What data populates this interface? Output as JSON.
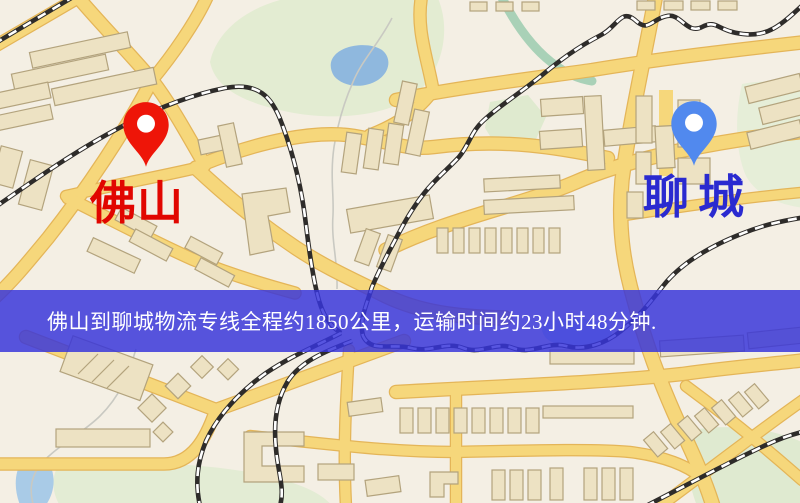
{
  "map": {
    "origin_marker": {
      "label": "佛山",
      "pin_color": "#ee1508",
      "label_color": "#e10600",
      "icon": "map-pin-icon"
    },
    "destination_marker": {
      "label": "聊城",
      "pin_color": "#5189ee",
      "label_color": "#2a2ad0",
      "icon": "map-pin-icon"
    }
  },
  "banner": {
    "text": "佛山到聊城物流专线全程约1850公里，运输时间约23小时48分钟.",
    "distance_text": "约1850公里",
    "duration_text": "约23小时48分钟",
    "background_rgba": "rgba(55,52,218,0.84)",
    "text_color": "#ffffff"
  },
  "palette": {
    "map_background": "#f4efe4",
    "road_fill": "#f6d77b",
    "road_border": "#e4b558",
    "building_fill": "#ede2c3",
    "building_border": "#b3a37d",
    "green_area": "#e3ecd2",
    "lake_water": "#8fb8de",
    "railway_dark": "#2e2c2a"
  }
}
